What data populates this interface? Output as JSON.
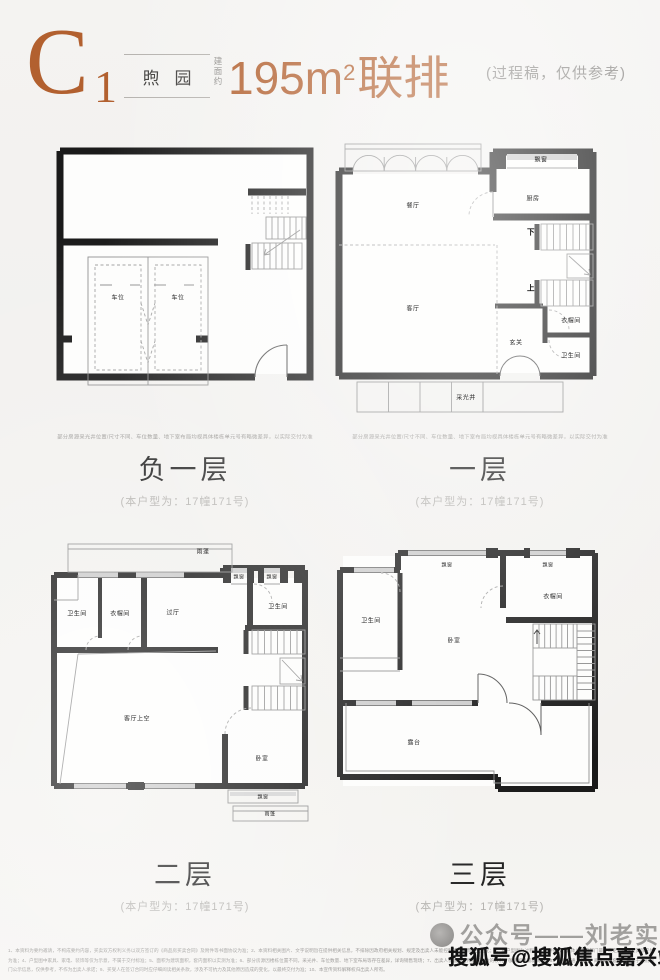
{
  "header": {
    "unit_letter": "C",
    "unit_number": "1",
    "community": "煦园",
    "area_prefix": "建面约",
    "area_value": "195m",
    "area_sup": "2",
    "area_suffix": "联排",
    "note": "(过程稿，仅供参考)"
  },
  "plans": [
    {
      "name": "负一层",
      "unit_note": "(本户型为：17幢171号)",
      "disclaimer": "部分房源采光井位置/尺寸不同、车位数量、地下室布局均视具体楼栋单元号有略微差异，以实际交付为准",
      "rooms": [
        {
          "label": "车位"
        },
        {
          "label": "车位"
        }
      ]
    },
    {
      "name": "一层",
      "unit_note": "(本户型为：17幢171号)",
      "disclaimer": "部分房源采光井位置/尺寸不同、车位数量、地下室布局均视具体楼栋单元号有略微差异，以实际交付为准",
      "rooms": [
        {
          "label": "餐厅"
        },
        {
          "label": "厨房"
        },
        {
          "label": "飘窗"
        },
        {
          "label": "客厅"
        },
        {
          "label": "玄关"
        },
        {
          "label": "衣帽间"
        },
        {
          "label": "卫生间"
        },
        {
          "label": "采光井"
        },
        {
          "label": "下"
        },
        {
          "label": "上"
        }
      ]
    },
    {
      "name": "二层",
      "unit_note": "(本户型为：17幢171号)",
      "rooms": [
        {
          "label": "雨蓬"
        },
        {
          "label": "飘窗"
        },
        {
          "label": "飘窗"
        },
        {
          "label": "卫生间"
        },
        {
          "label": "衣帽间"
        },
        {
          "label": "过厅"
        },
        {
          "label": "卫生间"
        },
        {
          "label": "客厅上空"
        },
        {
          "label": "卧室"
        },
        {
          "label": "飘窗"
        },
        {
          "label": "雨蓬"
        }
      ]
    },
    {
      "name": "三层",
      "unit_note": "(本户型为：17幢171号)",
      "rooms": [
        {
          "label": "飘窗"
        },
        {
          "label": "飘窗"
        },
        {
          "label": "衣帽间"
        },
        {
          "label": "卫生间"
        },
        {
          "label": "卧室"
        },
        {
          "label": "露台"
        }
      ]
    }
  ],
  "footer": {
    "fine_print": "1、本资料为要约邀请，不构成要约内容，买卖双方权利义务以双方签订的《商品房买卖合同》及附件等书面协议为准；2、本资料相关图片、文字说明旨在提供相关信息，不排除因政府相关规划、规定及出卖人未能控制的原因而发生变化；3、本户型图为过程稿，仅供参考，具体以政府部门最终审定的图纸及实际交付为准；4、户型图中家具、家电、装饰等仅为示意，不属于交付标准；5、面积为建筑面积，套内面积以实测为准；6、部分房源因楼栋位置不同，采光井、车位数量、地下室布局等存在差异，详询销售现场；7、出卖人保留对宣传资料修改的权利，敬请留意最新资料；8、相关交通、教育、商业等配套信息来源于政府部门公示信息，仅供参考，不作为出卖人承诺；9、买受人在签订合同时应仔细阅读相关条款，涉及不可抗力及其他原因造成的变化，以最终交付为准；10、本宣传资料解释权归出卖人所有。",
    "watermark_gray": "公众号——刘老实选房",
    "watermark_black": "搜狐号@搜狐焦点嘉兴站"
  },
  "colors": {
    "accent": "#b2602f",
    "wall": "#1a1a1a"
  }
}
